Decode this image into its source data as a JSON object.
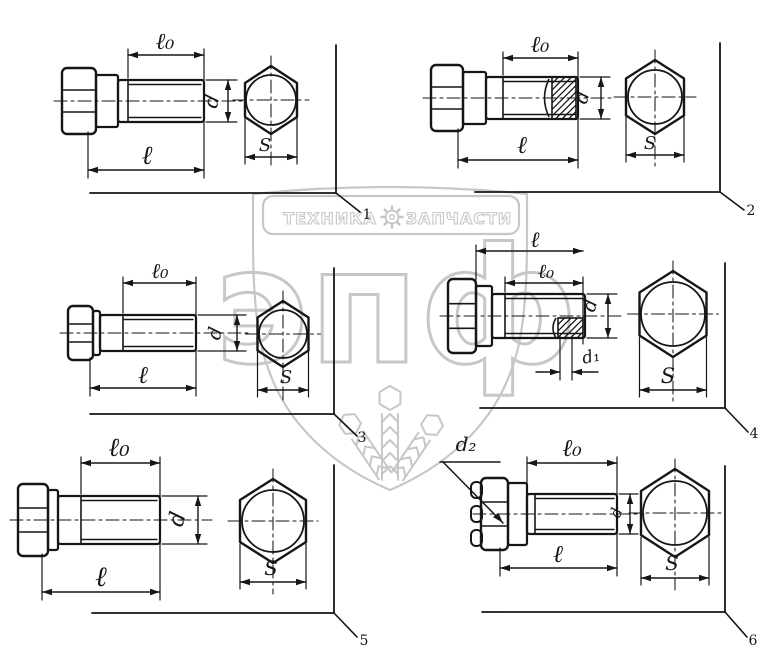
{
  "title": "Bolts dimension diagrams",
  "colors": {
    "ink": "#161616",
    "watermark": "#c7c7c7",
    "background": "#ffffff"
  },
  "watermark": {
    "brand_left": "ТЕХНИКА",
    "brand_right": "ЗАПЧАСТИ",
    "gear_icon": "gear",
    "letters": "эпф"
  },
  "panels": [
    {
      "number": "1",
      "labels": {
        "lo": "ℓ₀",
        "l": "ℓ",
        "d": "d",
        "s": "S"
      }
    },
    {
      "number": "2",
      "labels": {
        "lo": "ℓ₀",
        "l": "ℓ",
        "d": "d",
        "s": "S"
      }
    },
    {
      "number": "3",
      "labels": {
        "lo": "ℓ₀",
        "l": "ℓ",
        "d": "d",
        "s": "S"
      }
    },
    {
      "number": "4",
      "labels": {
        "l": "ℓ",
        "lo": "ℓ₀",
        "d": "d",
        "d1": "d₁",
        "s": "S"
      }
    },
    {
      "number": "5",
      "labels": {
        "lo": "ℓ₀",
        "l": "ℓ",
        "d": "d",
        "s": "S"
      }
    },
    {
      "number": "6",
      "labels": {
        "d2": "d₂",
        "lo": "ℓ₀",
        "l": "ℓ",
        "d": "d",
        "s": "S"
      }
    }
  ]
}
